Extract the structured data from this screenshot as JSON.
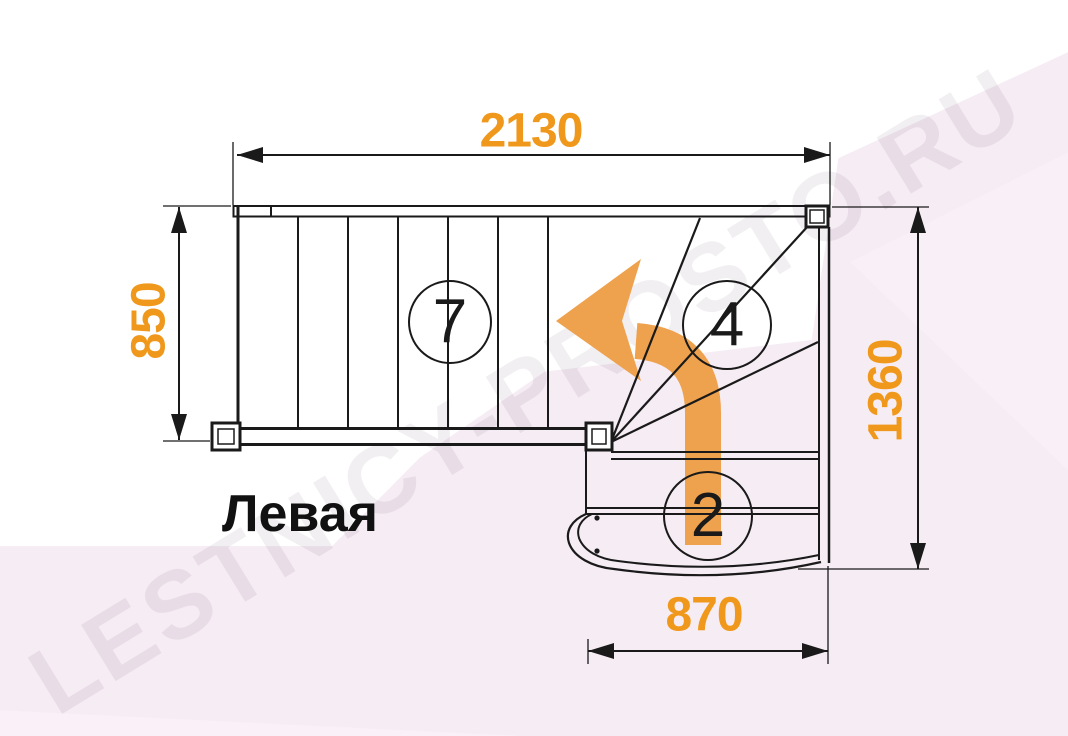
{
  "watermark": "LESTNICY-PROSTO.RU",
  "plan_label": "Левая",
  "dimensions": {
    "top": "2130",
    "left": "850",
    "right": "1360",
    "bottom": "870"
  },
  "step_counts": {
    "upper_flight": "7",
    "winder": "4",
    "lower_flight": "2"
  },
  "colors": {
    "line": "#1a1a1a",
    "dimension_text": "#F0981B",
    "direction_arrow": "#EFA24E",
    "background_pink": "#F6ECF4",
    "background_pink_light": "#F9EFF7",
    "background_pink_lighter": "#FAF1F8",
    "watermark": "rgba(96,74,90,0.085)"
  }
}
